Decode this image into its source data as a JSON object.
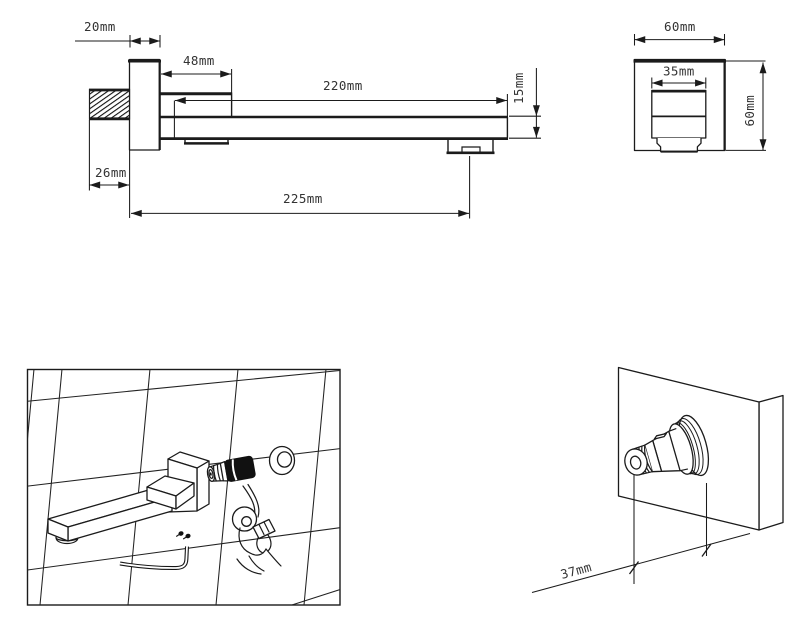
{
  "colors": {
    "background": "#ffffff",
    "ink": "#1b1b1b",
    "label": "#333333"
  },
  "views": {
    "spout_side_view": {
      "plate_depth": "20mm",
      "step_length": "48mm",
      "spout_length": "220mm",
      "spout_thickness": "15mm",
      "thread_length": "26mm",
      "overall_reach": "225mm"
    },
    "valve_front_view": {
      "body_width": "60mm",
      "spout_width": "35mm",
      "body_height": "60mm"
    },
    "installation_view": {
      "elements": [
        "tiled-wall",
        "wall-spout-3d",
        "valve-cartridge",
        "escutcheon-ring",
        "hand-with-washer",
        "allen-key",
        "mounting-screws"
      ]
    },
    "valve_3d_view": {
      "stem_protrusion": "37mm"
    }
  }
}
